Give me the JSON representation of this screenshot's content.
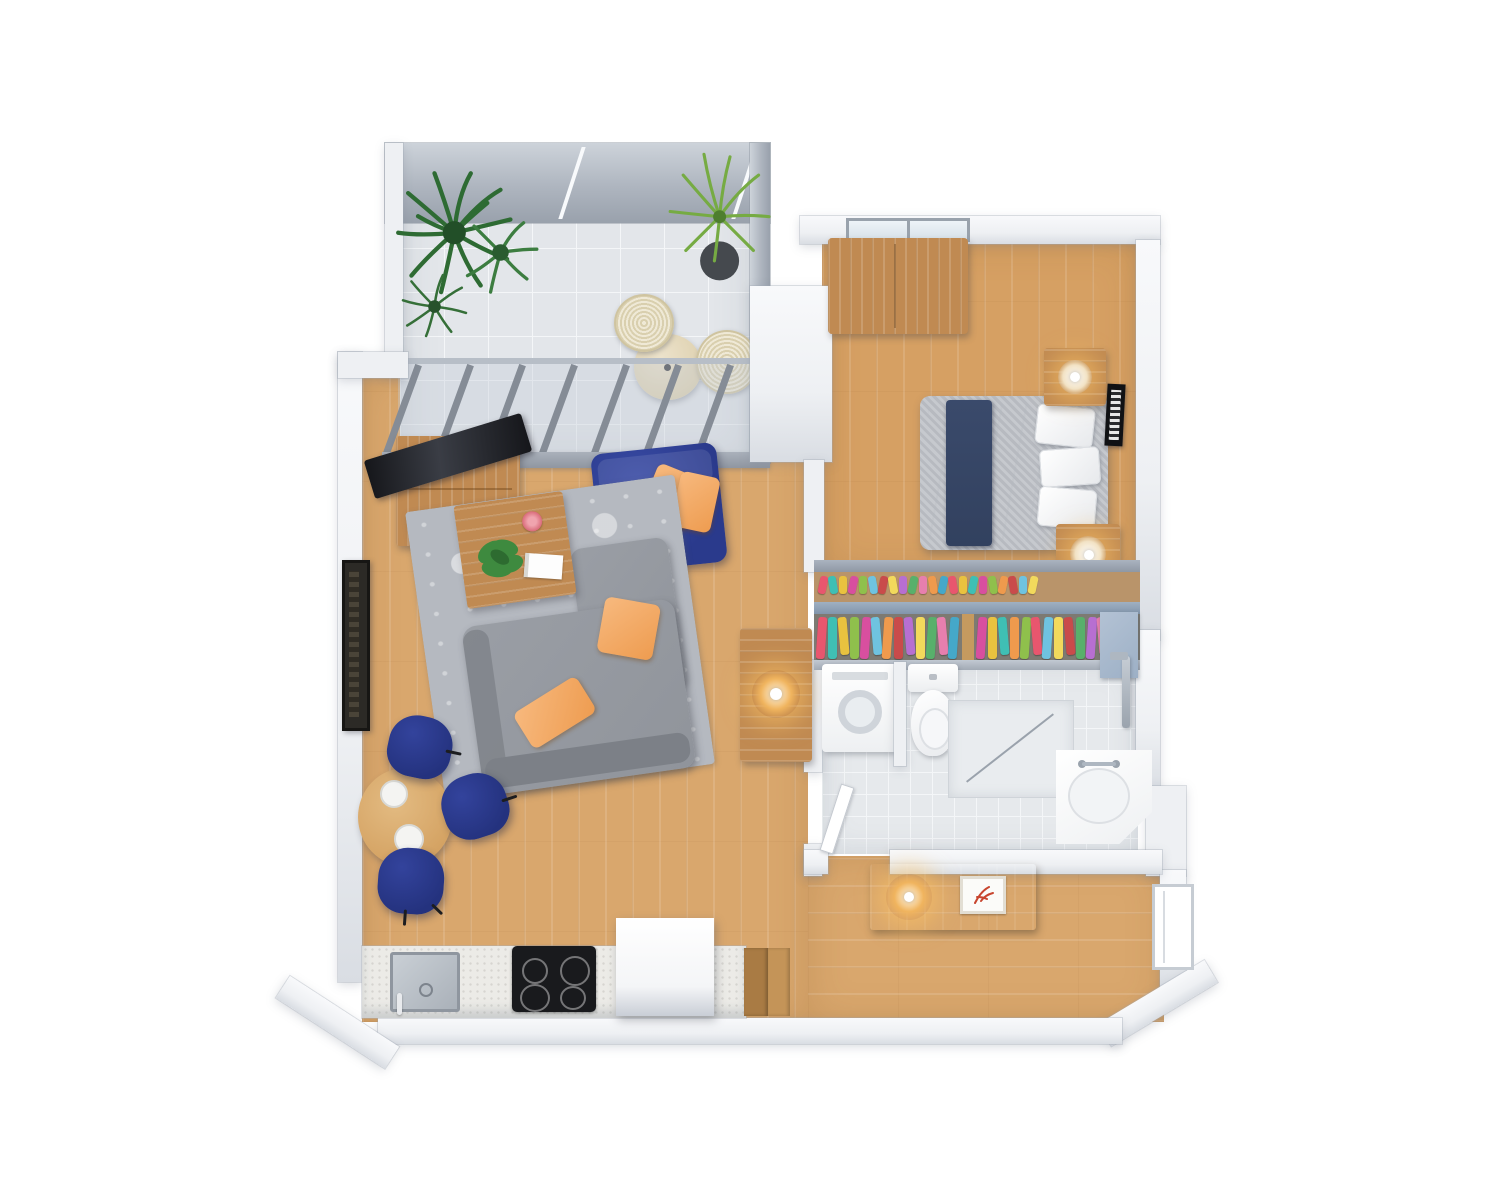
{
  "scene": {
    "kind": "3d-floor-plan-render",
    "view": "top-down isometric",
    "background": "#ffffff",
    "text_visible": ""
  },
  "palette": {
    "wall": "#eef0f3",
    "wall-hi": "#f8f9fb",
    "wall-lo": "#d9dde3",
    "glass": "#aeb5bf",
    "glass-hi": "#cdd3da",
    "glass-lo": "#99a1ac",
    "wood": "#d9a76d",
    "wood-bed": "#d6a063",
    "tile": "#e3e6ea",
    "btile": "#e6e9ec",
    "tile-line": "#f4f6f8",
    "furn-wood": "#c08a52",
    "walnut": "#8d5c33",
    "navy": "#2a3a8c",
    "navy-hi": "#3a4ca6",
    "navy-chair": "#24327e",
    "navy-bed": "#32415f",
    "orange": "#ee9c50",
    "orange-hi": "#f7b97e",
    "sofa-gray": "#90949b",
    "sofa-gray-dark": "#7c8087",
    "rug": "#b5b9c0",
    "rug-pattern": "#eceef1",
    "counter": "#ecebe7",
    "cooktop": "#191a1d",
    "amber": "#f0b45e",
    "chrome": "#9aa3ad",
    "plant-dark": "#2e6b33",
    "plant-light": "#76ab43",
    "pot": "#45494e",
    "bowl-pink": "#d96b7a",
    "tray-red": "#c8452f",
    "closet-door": "#9db0c6",
    "rail": "#97a0ac",
    "shelf-wood": "#b9946a"
  },
  "rooms": [
    {
      "name": "balcony-terrace",
      "floor": "gray ceramic tile",
      "furniture": [
        "large-potted-plant",
        "small-potted-plant",
        "potted-palm",
        "round-patio-table",
        "wicker-chair",
        "wicker-chair"
      ]
    },
    {
      "name": "living-room",
      "floor": "light oak plank",
      "furniture": [
        "tv-stand",
        "flatscreen-tv",
        "navy-loveseat",
        "gray-sofa",
        "patterned-rug",
        "coffee-table",
        "monstera-plant",
        "pink-bowl",
        "magazine",
        "side-table",
        "table-lamp",
        "framed-wall-art"
      ]
    },
    {
      "name": "dining-area",
      "floor": "light oak plank",
      "furniture": [
        "round-dining-table",
        "place-setting",
        "place-setting",
        "navy-dining-chair",
        "navy-dining-chair",
        "navy-dining-chair"
      ]
    },
    {
      "name": "kitchen",
      "floor": "light oak plank",
      "furniture": [
        "counter-run",
        "inset-sink",
        "induction-cooktop",
        "white-island-cabinet",
        "wood-step"
      ]
    },
    {
      "name": "bedroom",
      "floor": "light oak plank",
      "furniture": [
        "wood-dresser",
        "double-bed",
        "navy-bed-runner",
        "nightstand",
        "nightstand",
        "sphere-lamp",
        "sphere-lamp",
        "framed-wall-art",
        "window"
      ]
    },
    {
      "name": "walk-in-closet",
      "furniture": [
        "hanging-clothes-rail",
        "shoe-shelf",
        "closet-door"
      ]
    },
    {
      "name": "bathroom",
      "floor": "light tile",
      "furniture": [
        "washing-machine",
        "toilet",
        "walk-in-shower",
        "shower-fixture",
        "corner-sink",
        "swing-door"
      ]
    },
    {
      "name": "hallway",
      "floor": "light oak plank",
      "furniture": [
        "console-table",
        "globe-lamp",
        "decor-tray",
        "entry-door-opening"
      ]
    }
  ],
  "closet": {
    "clothes_left": [
      "#e8566e",
      "#3fbfb4",
      "#e9c23f",
      "#8fc04c",
      "#d84f9f",
      "#6fc3e0",
      "#ef9a4d",
      "#c94b4b",
      "#b76fd1",
      "#f2d95c",
      "#58b06b",
      "#e77fae",
      "#45a8c9",
      "#e2a23e"
    ],
    "clothes_right": [
      "#d84f9f",
      "#e9c23f",
      "#3fbfb4",
      "#ef9a4d",
      "#8fc04c",
      "#e8566e",
      "#6fc3e0",
      "#f2d95c",
      "#c94b4b",
      "#58b06b",
      "#b76fd1",
      "#e77fae",
      "#e2a23e",
      "#45a8c9",
      "#ef8585"
    ],
    "shoes": [
      "#e8566e",
      "#3fbfb4",
      "#e9c23f",
      "#d84f9f",
      "#8fc04c",
      "#6fc3e0",
      "#c94b4b",
      "#f2d95c",
      "#b76fd1",
      "#58b06b",
      "#e77fae",
      "#ef9a4d",
      "#45a8c9",
      "#e8566e",
      "#e9c23f",
      "#3fbfb4",
      "#d84f9f",
      "#8fc04c",
      "#ef9a4d",
      "#c94b4b",
      "#6fc3e0",
      "#f2d95c"
    ]
  }
}
